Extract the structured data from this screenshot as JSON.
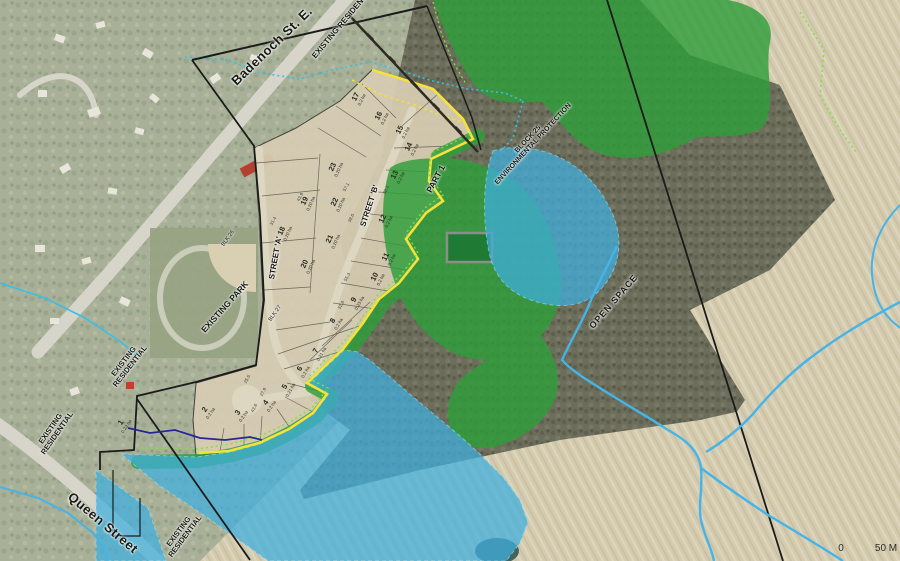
{
  "title": "Aerial photo with draft plan of subdivision overlay",
  "streets": {
    "badenoch": "Badenoch St. E.",
    "queen": "Queen Street",
    "street_a": "STREET 'A'",
    "street_b": "STREET 'B'"
  },
  "labels": {
    "existing_residential": "EXISTING RESIDENTIAL",
    "existing_l1": "EXISTING",
    "existing_l2": "RESIDENTIAL",
    "existing_park": "EXISTING PARK",
    "open_space": "OPEN SPACE",
    "part1": "PART 1",
    "block25_line1": "BLOCK 25",
    "block25_line2": "ENVIRONMENTAL PROTECTION",
    "blk26": "BLK 26",
    "blk27": "BLK 27"
  },
  "scale": {
    "zero": "0",
    "fifty": "50 M"
  },
  "colors": {
    "woodland_overlay": "#2f9e3b",
    "open_space_overlay": "#3fb0e0",
    "plan_limit_line": "#f5e23a",
    "buffer_dotted_line": "#7ce23f",
    "watercourse_line": "#45b4e8",
    "stream_overlay_line": "#26269a",
    "property_line": "#1b1b1b",
    "plan_fill": "#d7cdb3"
  },
  "lots": [
    {
      "number": "1",
      "area": "0.23 ha",
      "x": 123,
      "y": 424,
      "rot": -56
    },
    {
      "number": "2",
      "area": "0.2 ha",
      "x": 207,
      "y": 411,
      "rot": -56
    },
    {
      "number": "3",
      "area": "0.2 ha",
      "x": 240,
      "y": 414,
      "rot": -56
    },
    {
      "number": "4",
      "area": "0.2 ha",
      "x": 268,
      "y": 404,
      "rot": -56
    },
    {
      "number": "5",
      "area": "0.21 ha",
      "x": 287,
      "y": 388,
      "rot": -60
    },
    {
      "number": "6",
      "area": "0.2 ha",
      "x": 302,
      "y": 370,
      "rot": -60
    },
    {
      "number": "7",
      "area": "0.21 ha",
      "x": 318,
      "y": 352,
      "rot": -60
    },
    {
      "number": "8",
      "area": "0.2 ha",
      "x": 335,
      "y": 322,
      "rot": -60
    },
    {
      "number": "9",
      "area": "0.23 ha",
      "x": 356,
      "y": 301,
      "rot": -60
    },
    {
      "number": "10",
      "area": "0.2 ha",
      "x": 377,
      "y": 278,
      "rot": -64
    },
    {
      "number": "11",
      "area": "0.2 ha",
      "x": 388,
      "y": 258,
      "rot": -64
    },
    {
      "number": "12",
      "area": "0.2 ha",
      "x": 385,
      "y": 220,
      "rot": -64
    },
    {
      "number": "13",
      "area": "0.2 ha",
      "x": 397,
      "y": 176,
      "rot": -64
    },
    {
      "number": "14",
      "area": "0.2 ha",
      "x": 411,
      "y": 148,
      "rot": -64
    },
    {
      "number": "15",
      "area": "0.2 ha",
      "x": 402,
      "y": 131,
      "rot": -64
    },
    {
      "number": "16",
      "area": "0.2 ha",
      "x": 381,
      "y": 117,
      "rot": -64
    },
    {
      "number": "17",
      "area": "0.2 ha",
      "x": 358,
      "y": 98,
      "rot": -64
    },
    {
      "number": "18",
      "area": "0.20 ha",
      "x": 284,
      "y": 232,
      "rot": -66
    },
    {
      "number": "19",
      "area": "0.20 ha",
      "x": 307,
      "y": 202,
      "rot": -66
    },
    {
      "number": "20",
      "area": "0.20 ha",
      "x": 307,
      "y": 265,
      "rot": -66
    },
    {
      "number": "21",
      "area": "0.20 ha",
      "x": 332,
      "y": 240,
      "rot": -66
    },
    {
      "number": "22",
      "area": "0.20 ha",
      "x": 337,
      "y": 203,
      "rot": -66
    },
    {
      "number": "23",
      "area": "0.20 ha",
      "x": 335,
      "y": 168,
      "rot": -66
    }
  ],
  "dimensions": [
    {
      "t": "57.1",
      "x": 346,
      "y": 187
    },
    {
      "t": "43.9",
      "x": 300,
      "y": 197
    },
    {
      "t": "31.4",
      "x": 273,
      "y": 221
    },
    {
      "t": "38.0",
      "x": 351,
      "y": 218
    },
    {
      "t": "30.4",
      "x": 386,
      "y": 190
    },
    {
      "t": "55.3",
      "x": 347,
      "y": 277
    },
    {
      "t": "27.9",
      "x": 263,
      "y": 392
    },
    {
      "t": "25.5",
      "x": 247,
      "y": 379
    },
    {
      "t": "32.6",
      "x": 341,
      "y": 305
    },
    {
      "t": "43.6",
      "x": 254,
      "y": 408
    }
  ]
}
